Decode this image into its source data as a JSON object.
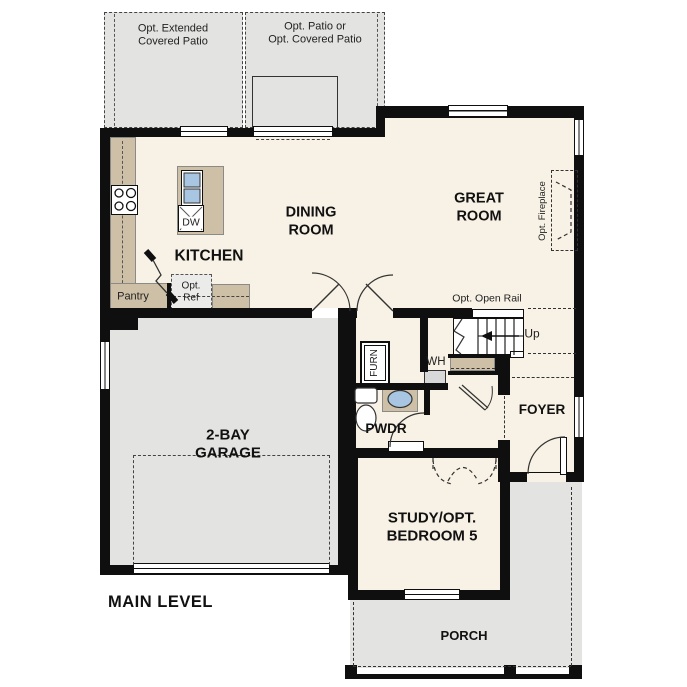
{
  "plan_title": "MAIN LEVEL",
  "colors": {
    "floor": "#f8f1e5",
    "concrete": "#e3e3e1",
    "counter_tan": "#cec0a6",
    "wall_black": "#0f0f0f",
    "fixture_blue": "#a8c6e2"
  },
  "labels": {
    "patio_left_line1": "Opt. Extended",
    "patio_left_line2": "Covered Patio",
    "patio_right_line1": "Opt. Patio or",
    "patio_right_line2": "Opt. Covered Patio",
    "dining_line1": "DINING",
    "dining_line2": "ROOM",
    "great_line1": "GREAT",
    "great_line2": "ROOM",
    "kitchen": "KITCHEN",
    "pantry": "Pantry",
    "opt_ref_line1": "Opt.",
    "opt_ref_line2": "Ref",
    "dishwasher": "DW",
    "garage_line1": "2-BAY",
    "garage_line2": "GARAGE",
    "furnace": "FURN",
    "water_heater": "WH",
    "powder": "PWDR",
    "stairs_up": "Up",
    "opt_open_rail": "Opt. Open Rail",
    "opt_fireplace": "Opt. Fireplace",
    "foyer": "FOYER",
    "study_line1": "STUDY/OPT.",
    "study_line2": "BEDROOM 5",
    "porch": "PORCH",
    "main_level": "MAIN LEVEL"
  }
}
